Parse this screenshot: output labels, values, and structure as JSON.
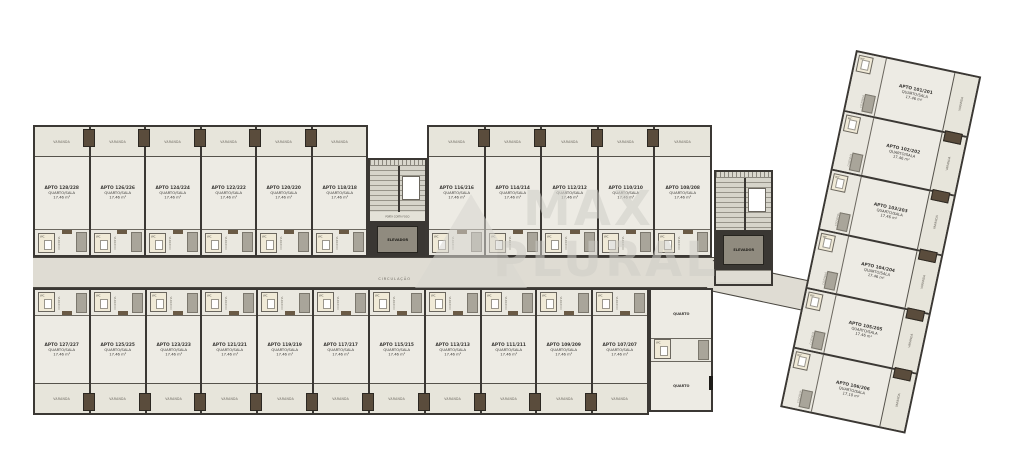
{
  "watermark": {
    "line1": "MAX",
    "line2": "PLURAL"
  },
  "labels": {
    "varanda": "VARANDA",
    "cozinha": "COZINHA",
    "wc": "WC",
    "circulacao": "CIRCULAÇÃO",
    "elevador": "ELEVADOR",
    "porta_corta_fogo": "PORTA CORTA FOGO",
    "quarto": "QUARTO"
  },
  "units": {
    "top": [
      {
        "name": "APTO 128/228",
        "type": "QUARTO/SALA",
        "area": "17.46 m²"
      },
      {
        "name": "APTO 126/226",
        "type": "QUARTO/SALA",
        "area": "17.46 m²"
      },
      {
        "name": "APTO 124/224",
        "type": "QUARTO/SALA",
        "area": "17.46 m²"
      },
      {
        "name": "APTO 122/222",
        "type": "QUARTO/SALA",
        "area": "17.46 m²"
      },
      {
        "name": "APTO 120/220",
        "type": "QUARTO/SALA",
        "area": "17.46 m²"
      },
      {
        "name": "APTO 118/218",
        "type": "QUARTO/SALA",
        "area": "17.46 m²"
      },
      {
        "name": "APTO 116/216",
        "type": "QUARTO/SALA",
        "area": "17.46 m²"
      },
      {
        "name": "APTO 114/214",
        "type": "QUARTO/SALA",
        "area": "17.46 m²"
      },
      {
        "name": "APTO 112/212",
        "type": "QUARTO/SALA",
        "area": "17.46 m²"
      },
      {
        "name": "APTO 110/210",
        "type": "QUARTO/SALA",
        "area": "17.46 m²"
      },
      {
        "name": "APTO 108/208",
        "type": "QUARTO/SALA",
        "area": "17.46 m²"
      }
    ],
    "bottom": [
      {
        "name": "APTO 127/227",
        "type": "QUARTO/SALA",
        "area": "17.46 m²"
      },
      {
        "name": "APTO 125/225",
        "type": "QUARTO/SALA",
        "area": "17.46 m²"
      },
      {
        "name": "APTO 123/223",
        "type": "QUARTO/SALA",
        "area": "17.46 m²"
      },
      {
        "name": "APTO 121/221",
        "type": "QUARTO/SALA",
        "area": "17.46 m²"
      },
      {
        "name": "APTO 119/219",
        "type": "QUARTO/SALA",
        "area": "17.46 m²"
      },
      {
        "name": "APTO 117/217",
        "type": "QUARTO/SALA",
        "area": "17.46 m²"
      },
      {
        "name": "APTO 115/215",
        "type": "QUARTO/SALA",
        "area": "17.46 m²"
      },
      {
        "name": "APTO 113/213",
        "type": "QUARTO/SALA",
        "area": "17.46 m²"
      },
      {
        "name": "APTO 111/211",
        "type": "QUARTO/SALA",
        "area": "17.46 m²"
      },
      {
        "name": "APTO 109/209",
        "type": "QUARTO/SALA",
        "area": "17.46 m²"
      },
      {
        "name": "APTO 107/207",
        "type": "QUARTO/SALA",
        "area": "17.46 m²"
      }
    ],
    "wing": [
      {
        "name": "APTO 101/201",
        "type": "QUARTO/SALA",
        "area": "17.46 m²"
      },
      {
        "name": "APTO 102/202",
        "type": "QUARTO/SALA",
        "area": "17.46 m²"
      },
      {
        "name": "APTO 103/203",
        "type": "QUARTO/SALA",
        "area": "17.46 m²"
      },
      {
        "name": "APTO 104/204",
        "type": "QUARTO/SALA",
        "area": "17.46 m²"
      },
      {
        "name": "APTO 105/205",
        "type": "QUARTO/SALA",
        "area": "17.46 m²"
      },
      {
        "name": "APTO 106/206",
        "type": "QUARTO/SALA",
        "area": "17.10 m²"
      }
    ]
  }
}
